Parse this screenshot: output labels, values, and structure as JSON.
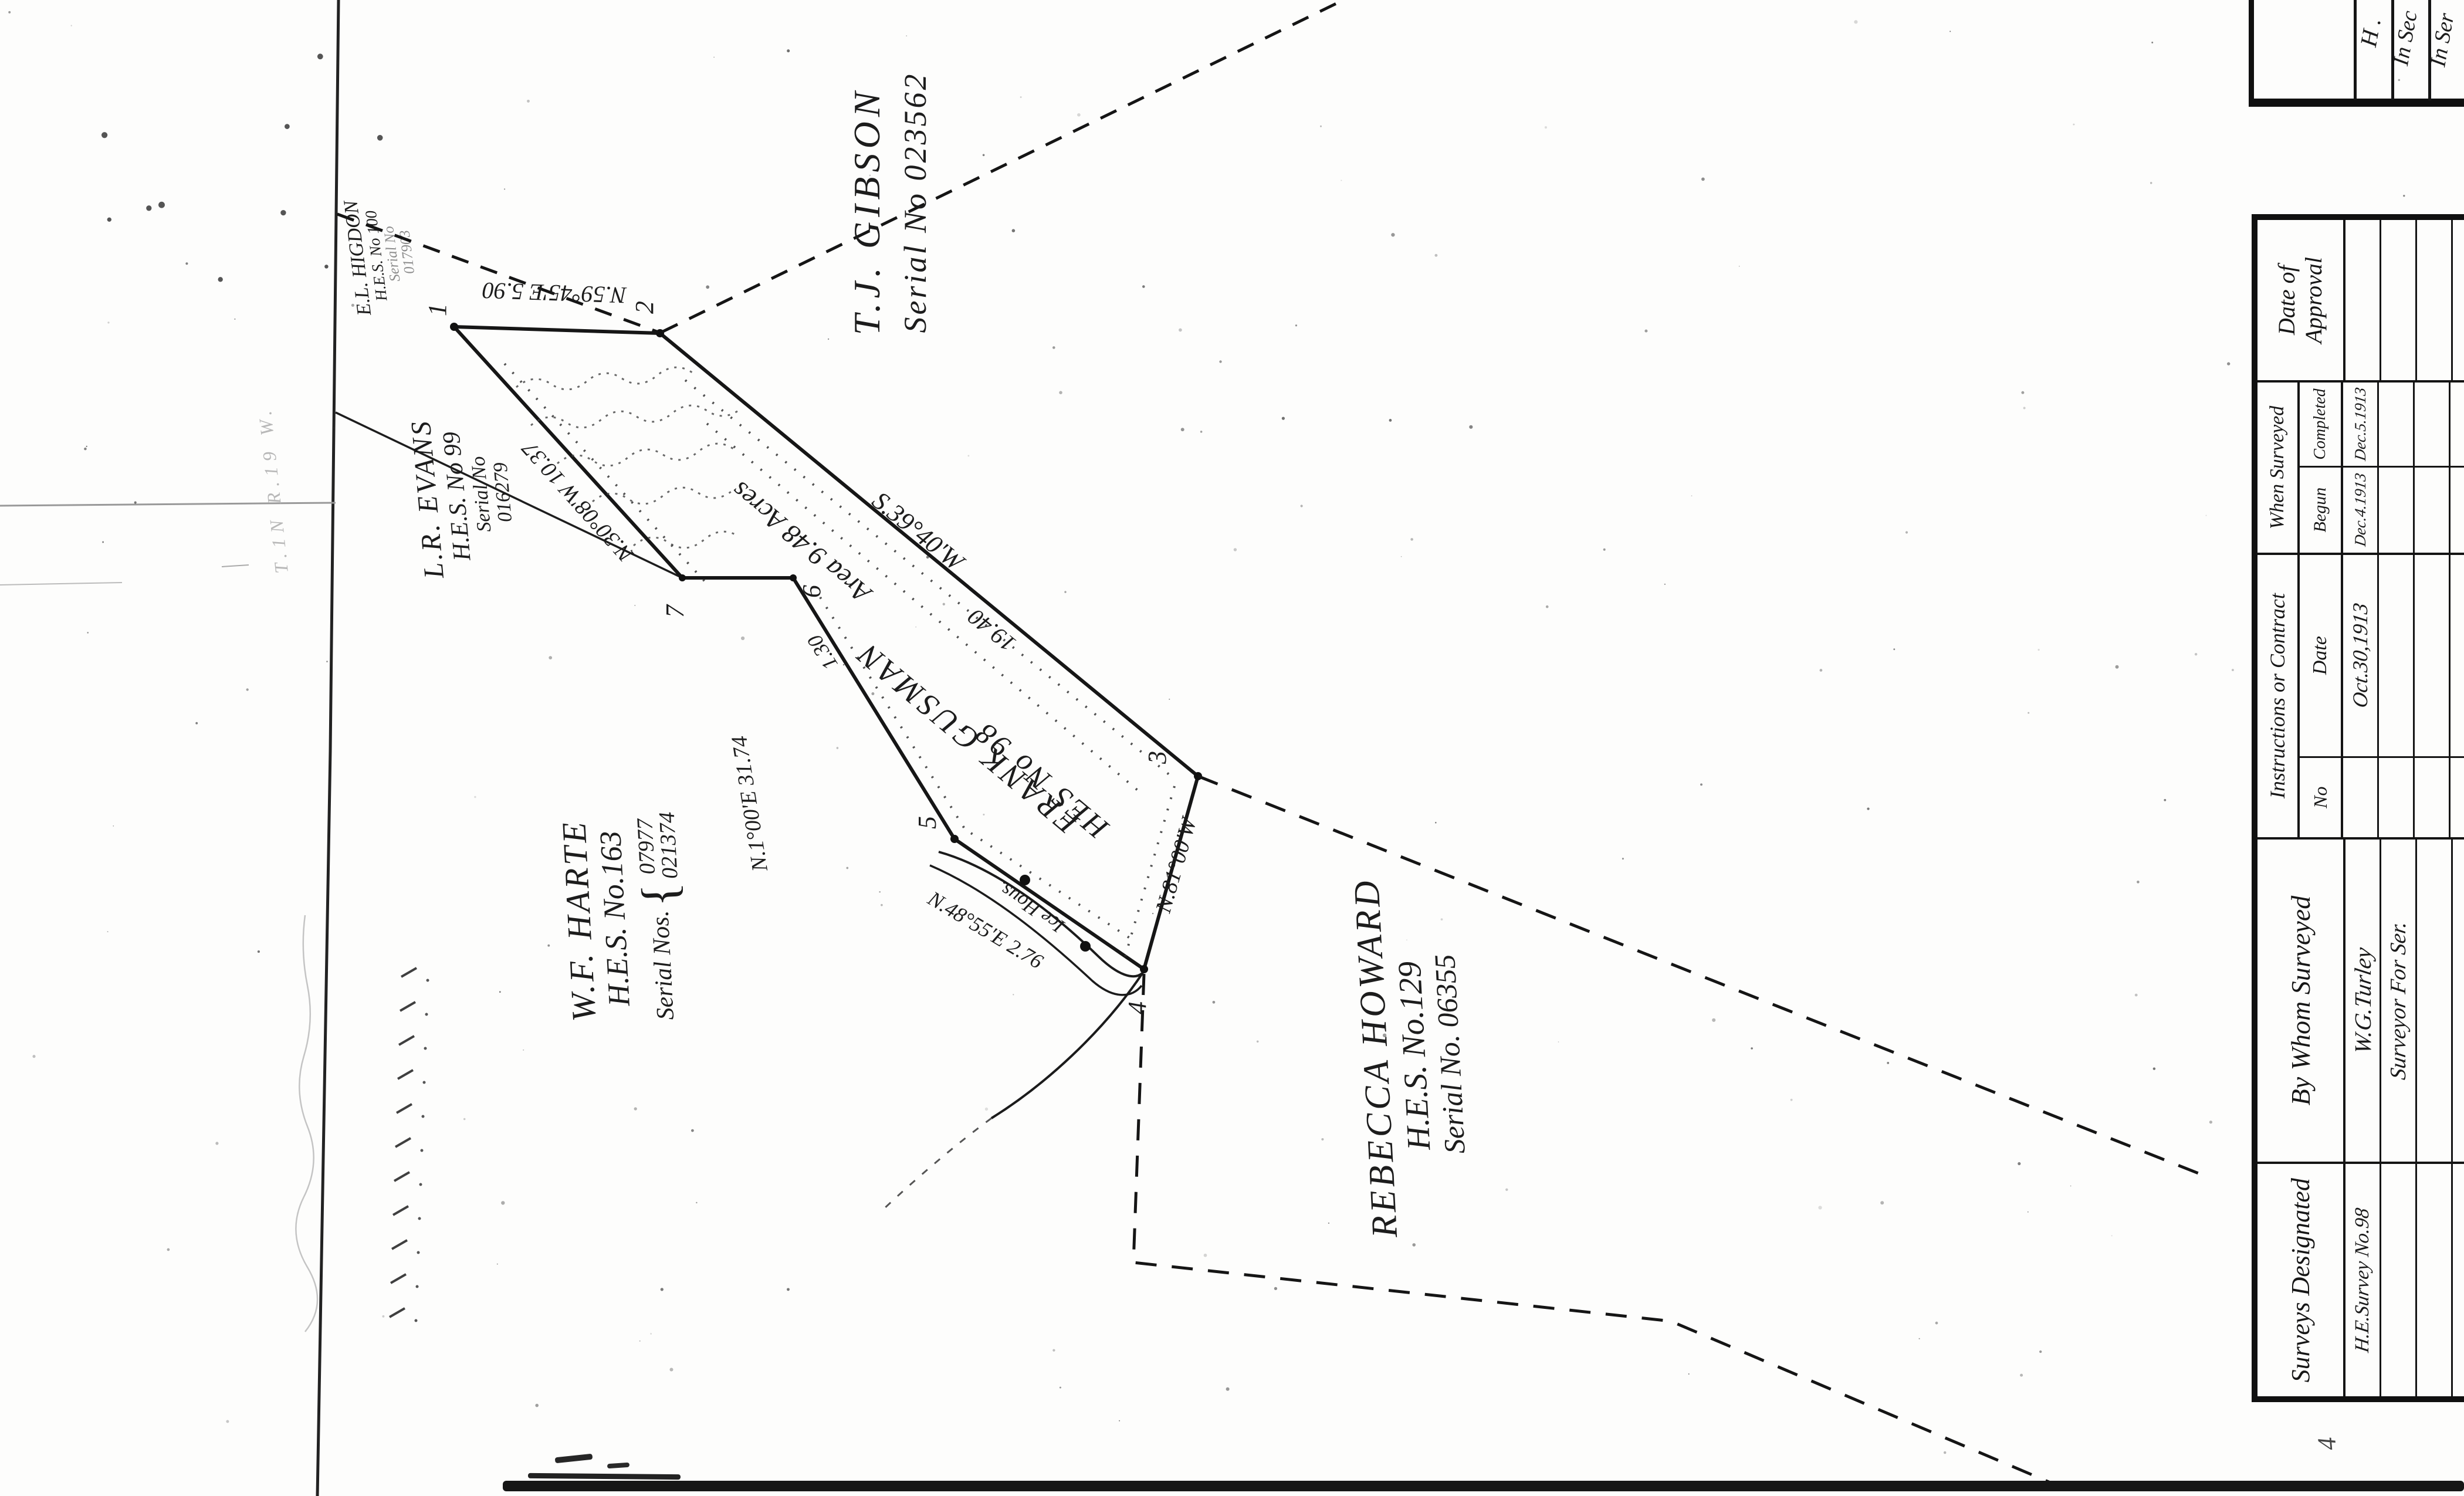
{
  "map": {
    "parcels": {
      "gibson": {
        "name": "T.J. GIBSON",
        "serial": "Serial No 023562"
      },
      "higdon": {
        "name": "E.L. HIGDON",
        "hes": "H.E.S. No 100",
        "serial_label": "Serial No",
        "serial": "017903"
      },
      "evans": {
        "name": "L.R. EVANS",
        "hes": "H.E.S. No 99",
        "serial_label": "Serial No",
        "serial": "016279"
      },
      "harte": {
        "name": "W.F. HARTE",
        "hes": "H.E.S. No.163",
        "serial_label": "Serial Nos.",
        "serial1": "07977",
        "serial2": "021374"
      },
      "gusman": {
        "name": "FRANK GUSMAN",
        "hes": "HES No 98",
        "area": "Area 9.48 Acres"
      },
      "howard": {
        "name": "REBECCA HOWARD",
        "hes": "H.E.S. No.129",
        "serial": "Serial No. 06355"
      }
    },
    "corners": [
      "1",
      "2",
      "3",
      "4",
      "5",
      "6",
      "7"
    ],
    "bearings": {
      "line_1_2": "N.59°45'E 5.90",
      "line_2_3": "S.39°40'W",
      "line_2_3_dist": "19.40",
      "line_3_4": "N.81°00'W",
      "line_5_4": "N.48°55'E 2.76",
      "line_6_5": "N.1°00'E 31.74",
      "line_7_1": "N.30°08'W 10.37",
      "notch_dist": "1.30"
    },
    "labels": {
      "ice_house": "Ice Hous.",
      "pencil_note": "T.1N R.19 W.",
      "stray_mark": "4"
    }
  },
  "table": {
    "columns": [
      {
        "header": "Surveys Designated",
        "rows": [
          "H.E.Survey No.98",
          "",
          "",
          ""
        ]
      },
      {
        "header": "By Whom Surveyed",
        "rows": [
          "W.G.Turley",
          "Surveyor For Ser.",
          "",
          ""
        ]
      },
      {
        "header": "Instructions or Contract",
        "sub": [
          {
            "label": "No",
            "rows": [
              "",
              "",
              "",
              ""
            ]
          },
          {
            "label": "Date",
            "rows": [
              "Oct.30,1913",
              "",
              "",
              ""
            ]
          }
        ]
      },
      {
        "header": "When Surveyed",
        "sub": [
          {
            "label": "Begun",
            "rows": [
              "Dec.4.1913",
              "",
              "",
              ""
            ]
          },
          {
            "label": "Completed",
            "rows": [
              "Dec.5.1913",
              "",
              "",
              ""
            ]
          }
        ]
      },
      {
        "header": "Date of Approval",
        "rows": [
          "",
          "",
          "",
          ""
        ]
      }
    ]
  },
  "fragment_table": {
    "cells": [
      "H .",
      "In Sec",
      "In Ser"
    ]
  }
}
